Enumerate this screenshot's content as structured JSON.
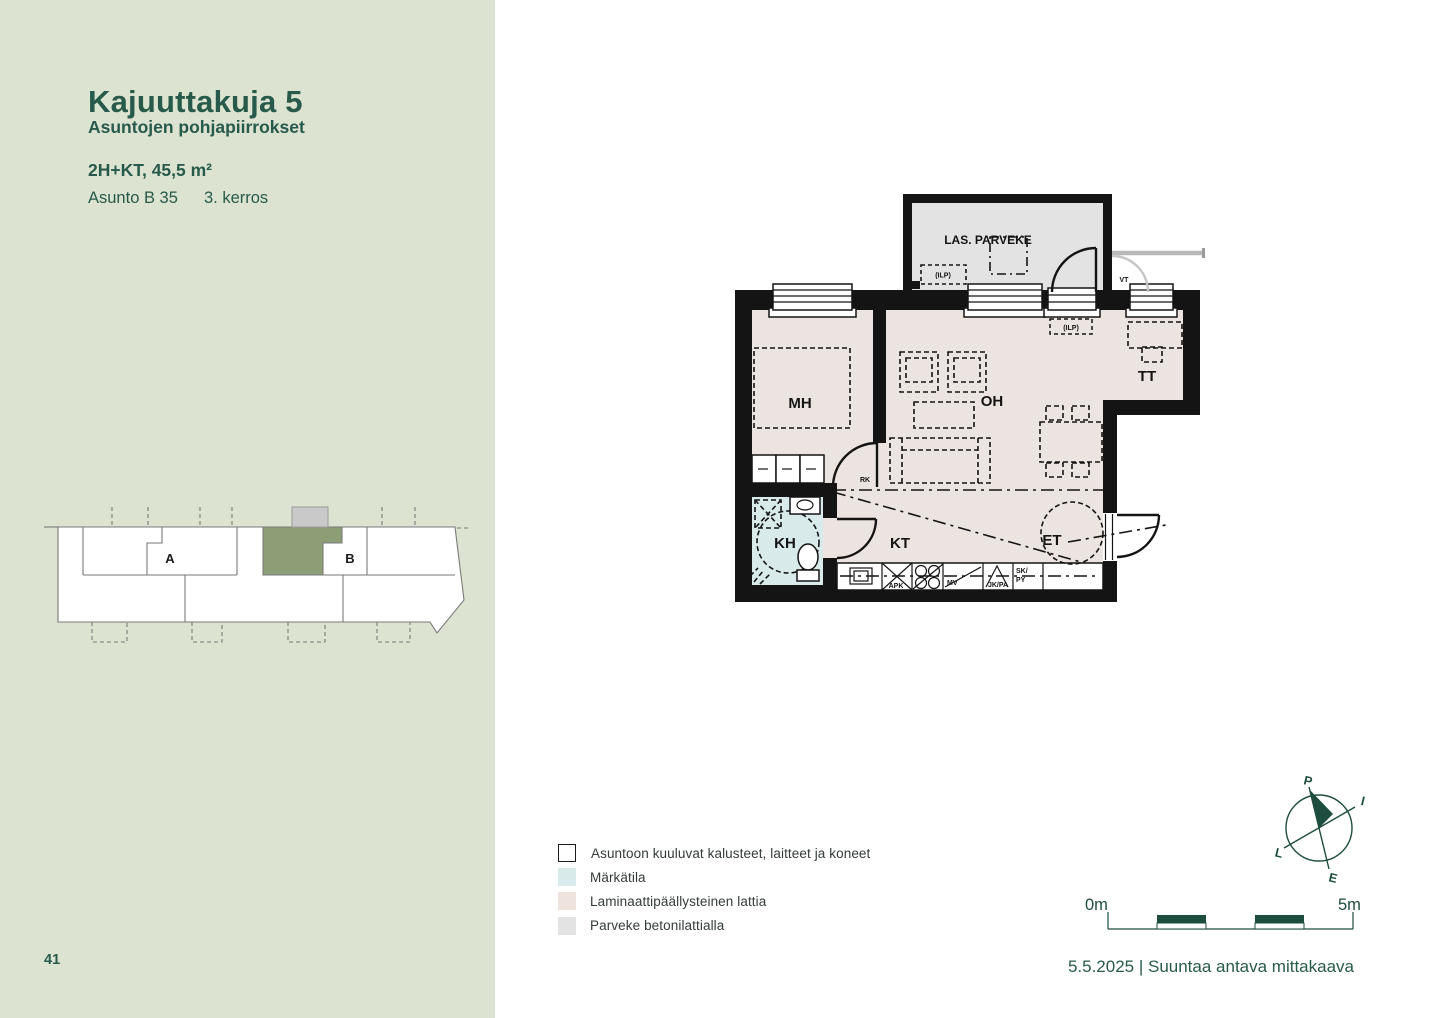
{
  "page": {
    "number": "41"
  },
  "sidebar": {
    "title": "Kajuuttakuja 5",
    "subtitle": "Asuntojen pohjapiirrokset",
    "apartment_type": "2H+KT, 45,5 m²",
    "apartment_id": "Asunto B 35",
    "floor": "3. kerros",
    "locator": {
      "section_a": "A",
      "section_b": "B"
    }
  },
  "plan": {
    "rooms": {
      "balcony": "LAS. PARVEKE",
      "bedroom": "MH",
      "living_room": "OH",
      "workspace": "TT",
      "bathroom": "KH",
      "kitchen": "KT",
      "entrance": "ET"
    },
    "labels": {
      "vt": "VT",
      "rk": "RK",
      "ilp_balcony": "(ILP)",
      "ilp_living": "(ILP)",
      "dishwasher": "APK",
      "microwave": "MV",
      "fridge_freezer": "JK/PA",
      "cabinet_line1": "SK/",
      "cabinet_line2": "PY"
    }
  },
  "legend": {
    "items": [
      {
        "label": "Asuntoon kuuluvat kalusteet, laitteet ja koneet",
        "swatch": "#ffffff"
      },
      {
        "label": "Märkätila",
        "swatch": "#d9eaeb"
      },
      {
        "label": "Laminaattipäällysteinen lattia",
        "swatch": "#eee3df"
      },
      {
        "label": "Parveke betonilattialla",
        "swatch": "#e3e3e3"
      }
    ]
  },
  "compass": {
    "north": "P",
    "east": "I",
    "south": "E",
    "west": "L"
  },
  "scale_bar": {
    "start": "0m",
    "end": "5m"
  },
  "footer": {
    "date_line": "5.5.2025 | Suuntaa antava mittakaava"
  },
  "colors": {
    "sidebar_bg": "#dce3d0",
    "brand_green": "#275a4a",
    "plan_black": "#141414",
    "laminate_floor": "#ece4e0",
    "wet_room": "#d9eaeb",
    "balcony_floor": "#e3e3e3",
    "locator_highlight": "#8d9d76",
    "locator_balcony": "#c9c9c9",
    "scale_green": "#1d4d3e"
  }
}
